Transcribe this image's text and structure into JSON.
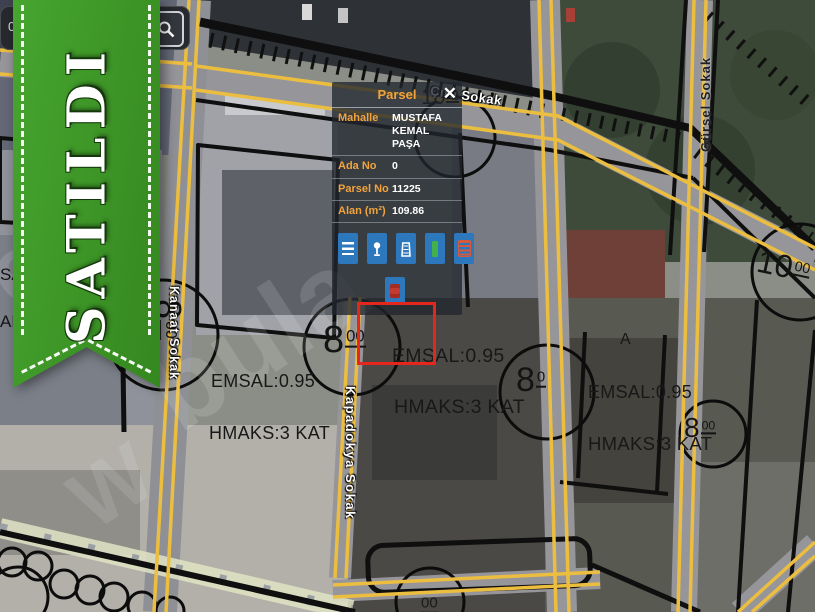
{
  "search": {
    "value": "0"
  },
  "ribbon": {
    "label": "SATILDI"
  },
  "popup": {
    "title": "Parsel",
    "close": "✕",
    "rows": [
      {
        "label": "Mahalle",
        "value": "MUSTAFA KEMAL PAŞA"
      },
      {
        "label": "Ada No",
        "value": "0"
      },
      {
        "label": "Parsel No",
        "value": "11225"
      },
      {
        "label": "Alan (m²)",
        "value": "109.86"
      }
    ],
    "tools": [
      "menu-icon",
      "pin-icon",
      "building-icon",
      "measure-icon",
      "battery-icon",
      "delete-icon"
    ]
  },
  "map": {
    "streets": {
      "cira": "Çıra Sokak",
      "gursel": "Gürsel Sokak",
      "kapadokya": "Kapadokya Sokak",
      "kanaat": "Kanaat Sokak"
    },
    "zoning": {
      "left": {
        "emsal": "EMSAL:0.95",
        "hmaks": "HMAKS:3 KAT"
      },
      "center": {
        "emsal": "EMSAL:0.95",
        "hmaks": "HMAKS:3 KAT"
      },
      "right": {
        "emsal": "EMSAL:0.95",
        "hmaks": "HMAKS:3 KAT"
      }
    },
    "block_label": "A",
    "fragments": {
      "sa": "SA",
      "ak": "AK"
    },
    "dims": {
      "d_popup": {
        "main": "10",
        "sup": "00"
      },
      "d_topright": {
        "main": "10",
        "sup": "00"
      },
      "d_left": {
        "main": "8",
        "sup": "00"
      },
      "d_center": {
        "main": "8",
        "sup": "00"
      },
      "d_mid": {
        "main": "8",
        "sup": "0"
      },
      "d_right": {
        "main": "8",
        "sup": "00"
      },
      "d_bottom": {
        "sup": "00"
      }
    },
    "watermark": {
      "w1": "e",
      "w2": "bula",
      "w3": "W"
    }
  },
  "colors": {
    "accent_orange": "#f2a33c",
    "button_blue": "#2d77bd",
    "ribbon_green": "#3f9c28",
    "highlight_red": "#e5261d",
    "road_yellow": "#ecbe40"
  }
}
